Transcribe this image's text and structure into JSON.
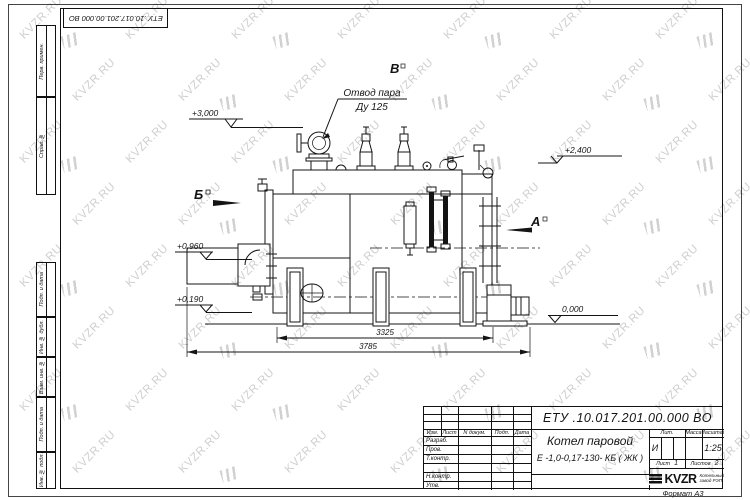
{
  "frame": {
    "doc_number_top": "ЕТУ .10.017.201.00.000  ВО",
    "format_label": "Формат А3",
    "left_strip": [
      {
        "label": "Перв. примен."
      },
      {
        "label": "Справ. №"
      },
      {
        "label": "Подп. и дата"
      },
      {
        "label": "Инв. № дубл."
      },
      {
        "label": "Взам. инв. №"
      },
      {
        "label": "Подп. и дата"
      },
      {
        "label": "Инв. № подл."
      }
    ]
  },
  "title_block": {
    "doc_number": "ЕТУ .10.017.201.00.000  ВО",
    "product_name_line1": "Котел паровой",
    "product_name_line2": "Е -1,0-0,17-130- КБ ( ЖК )",
    "columns_header": {
      "izm": "Изм.",
      "list": "Лист",
      "n_dokum": "N докум.",
      "podp": "Подп.",
      "data": "Дата"
    },
    "signature_rows": [
      "Разраб.",
      "Пров.",
      "Т.контр.",
      "Н.контр.",
      "Утв."
    ],
    "lit_header": "Лит.",
    "lit_value": "И",
    "mass_header": "Масса",
    "scale_header": "Масштаб",
    "scale_value": "1:25",
    "sheet_label": "Лист",
    "sheet_value": "1",
    "sheets_label": "Листов",
    "sheets_value": "2",
    "company": {
      "logo_text": "KVZR",
      "sub_line1": "Котельный",
      "sub_line2": "завод РЭП"
    }
  },
  "drawing": {
    "callout_steam_outlet": {
      "line1": "Отвод пара",
      "line2": "Ду 125"
    },
    "view_labels": {
      "a": "А",
      "b": "Б",
      "v": "В"
    },
    "elevations": {
      "top": "+3,000",
      "right_upper": "+2,400",
      "front_mid": "+0,960",
      "front_low": "+0,190",
      "ground": "0,000"
    },
    "dimensions": {
      "length_boiler": "3325",
      "length_overall": "3785"
    }
  },
  "watermark": {
    "text": "KVZR.RU",
    "color": "#c3c3c3"
  }
}
